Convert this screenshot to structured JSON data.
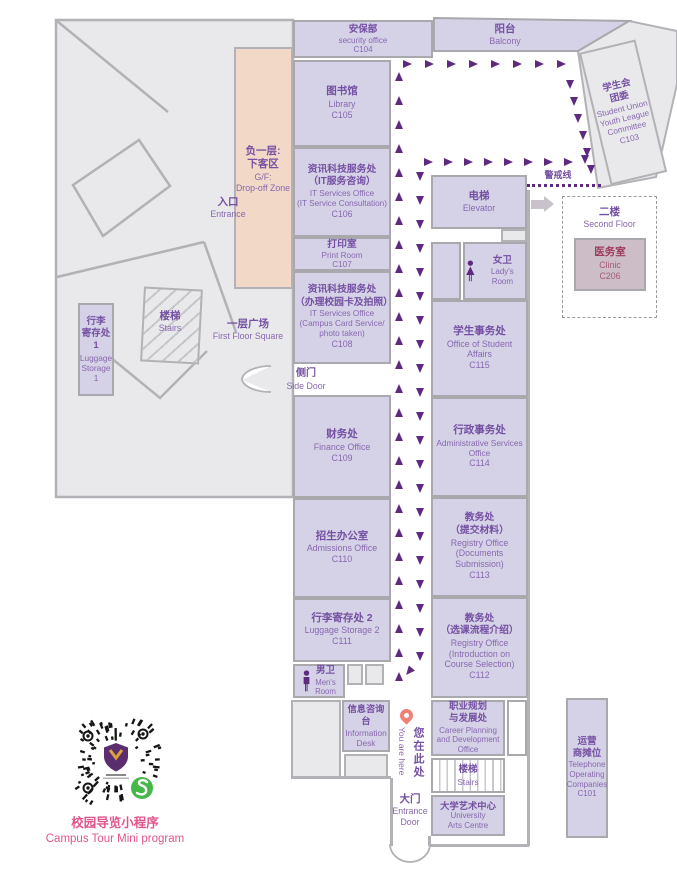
{
  "rooms": {
    "c104": {
      "zh": [
        "安保部"
      ],
      "en": [
        "security office"
      ],
      "code": "C104"
    },
    "balcony": {
      "zh": [
        "阳台"
      ],
      "en": [
        "Balcony"
      ]
    },
    "c105": {
      "zh": [
        "图书馆"
      ],
      "en": [
        "Library"
      ],
      "code": "C105"
    },
    "c106": {
      "zh": [
        "资讯科技服务处",
        "（IT服务咨询）"
      ],
      "en": [
        "IT Services Office",
        "(IT Service Consultation)"
      ],
      "code": "C106"
    },
    "c107": {
      "zh": [
        "打印室"
      ],
      "en": [
        "Print Room"
      ],
      "code": "C107"
    },
    "c108": {
      "zh": [
        "资讯科技服务处",
        "（办理校园卡及拍照）"
      ],
      "en": [
        "IT Services Office",
        "(Campus Card Service/",
        "photo taken)"
      ],
      "code": "C108"
    },
    "c109": {
      "zh": [
        "财务处"
      ],
      "en": [
        "Finance Office"
      ],
      "code": "C109"
    },
    "c110": {
      "zh": [
        "招生办公室"
      ],
      "en": [
        "Admissions Office"
      ],
      "code": "C110"
    },
    "c111": {
      "zh": [
        "行李寄存处 2"
      ],
      "en": [
        "Luggage Storage 2"
      ],
      "code": "C111"
    },
    "mens": {
      "zh": [
        "男卫"
      ],
      "en": [
        "Men's",
        "Room"
      ]
    },
    "infodesk": {
      "zh": [
        "信息咨询台"
      ],
      "en": [
        "Information",
        "Desk"
      ]
    },
    "elevator": {
      "zh": [
        "电梯"
      ],
      "en": [
        "Elevator"
      ]
    },
    "ladies": {
      "zh": [
        "女卫"
      ],
      "en": [
        "Lady's Room"
      ]
    },
    "c115": {
      "zh": [
        "学生事务处"
      ],
      "en": [
        "Office of Student",
        "Affairs"
      ],
      "code": "C115"
    },
    "c114": {
      "zh": [
        "行政事务处"
      ],
      "en": [
        "Administrative Services",
        "Office"
      ],
      "code": "C114"
    },
    "c113": {
      "zh": [
        "教务处",
        "（提交材料）"
      ],
      "en": [
        "Registry Office",
        "(Documents",
        "Submission)"
      ],
      "code": "C113"
    },
    "c112": {
      "zh": [
        "教务处",
        "（选课流程介绍）"
      ],
      "en": [
        "Registry Office",
        "(Introduction on",
        "Course Selection)"
      ],
      "code": "C112"
    },
    "career": {
      "zh": [
        "职业规划",
        "与发展处"
      ],
      "en": [
        "Career Planning",
        "and Development",
        "Office"
      ]
    },
    "stairs_br": {
      "zh": [
        "楼梯"
      ],
      "en": [
        "Stairs"
      ]
    },
    "arts": {
      "zh": [
        "大学艺术中心"
      ],
      "en": [
        "University",
        "Arts Centre"
      ]
    },
    "c101": {
      "zh": [
        "运营",
        "商摊位"
      ],
      "en": [
        "Telephone",
        "Operating",
        "Companies"
      ],
      "code": "C101"
    },
    "c103": {
      "zh": [
        "学生会",
        "团委"
      ],
      "en": [
        "Student Union",
        "Youth League",
        "Committee"
      ],
      "code": "C103"
    },
    "c206": {
      "zh": [
        "医务室"
      ],
      "en": [
        "Clinic"
      ],
      "code": "C206"
    },
    "luggage1": {
      "zh": [
        "行李",
        "寄存处1"
      ],
      "en": [
        "Luggage",
        "Storage 1"
      ]
    }
  },
  "areas": {
    "entrance": {
      "zh": [
        "入口"
      ],
      "en": [
        "Entrance"
      ]
    },
    "dropoff": {
      "zh": [
        "负一层:",
        "下客区"
      ],
      "en": [
        "G/F:",
        "Drop-off Zone"
      ]
    },
    "stairs_left": {
      "zh": [
        "楼梯"
      ],
      "en": [
        "Stairs"
      ]
    },
    "square": {
      "zh": [
        "一层广场"
      ],
      "en": [
        "First Floor Square"
      ]
    },
    "second_floor": {
      "zh": [
        "二楼"
      ],
      "en": [
        "Second Floor"
      ]
    },
    "side_door": {
      "zh": [
        "侧门"
      ],
      "en": [
        "Side Door"
      ]
    },
    "main_door": {
      "zh": [
        "大门"
      ],
      "en": [
        "Entrance",
        "Door"
      ]
    },
    "warning_line": {
      "zh": [
        "警戒线"
      ]
    },
    "you_are_here": {
      "zh": "您在此处",
      "en": "You are here"
    },
    "qr_caption": {
      "zh": "校园导览小程序",
      "en": "Campus Tour Mini program"
    }
  },
  "colors": {
    "room_fill": "#d5d2e7",
    "gray_fill": "#e9e9ec",
    "peach_fill": "#f2d8c7",
    "clinic_fill": "#ccbdc7",
    "zh_text": "#7450a2",
    "en_text": "#8767ae",
    "arrow": "#5e2a80",
    "warning": "#5e2a80",
    "pin": "#ee8274",
    "pink": "#e0568c",
    "green_badge": "#45b849",
    "wall": "#b2b2b6"
  },
  "tour_path": {
    "segments": [
      {
        "dir": "up",
        "x": 395,
        "y": 672,
        "dx": 0,
        "dy": -24,
        "count": 26
      },
      {
        "dir": "right",
        "x": 403,
        "y": 60,
        "dx": 22,
        "dy": 0,
        "count": 8
      },
      {
        "dir": "down",
        "x": 566,
        "y": 80,
        "dx": 4.2,
        "dy": 17,
        "count": 6
      },
      {
        "dir": "right",
        "x": 424,
        "y": 158,
        "dx": 20,
        "dy": 0,
        "count": 8
      },
      {
        "dir": "down",
        "x": 581,
        "y": 155,
        "dx": 0,
        "dy": 0,
        "count": 1
      },
      {
        "dir": "down",
        "x": 416,
        "y": 172,
        "dx": 0,
        "dy": 24,
        "count": 21
      },
      {
        "dir": "downleft",
        "x": 405,
        "y": 667,
        "dx": 0,
        "dy": 0,
        "count": 1
      }
    ]
  }
}
